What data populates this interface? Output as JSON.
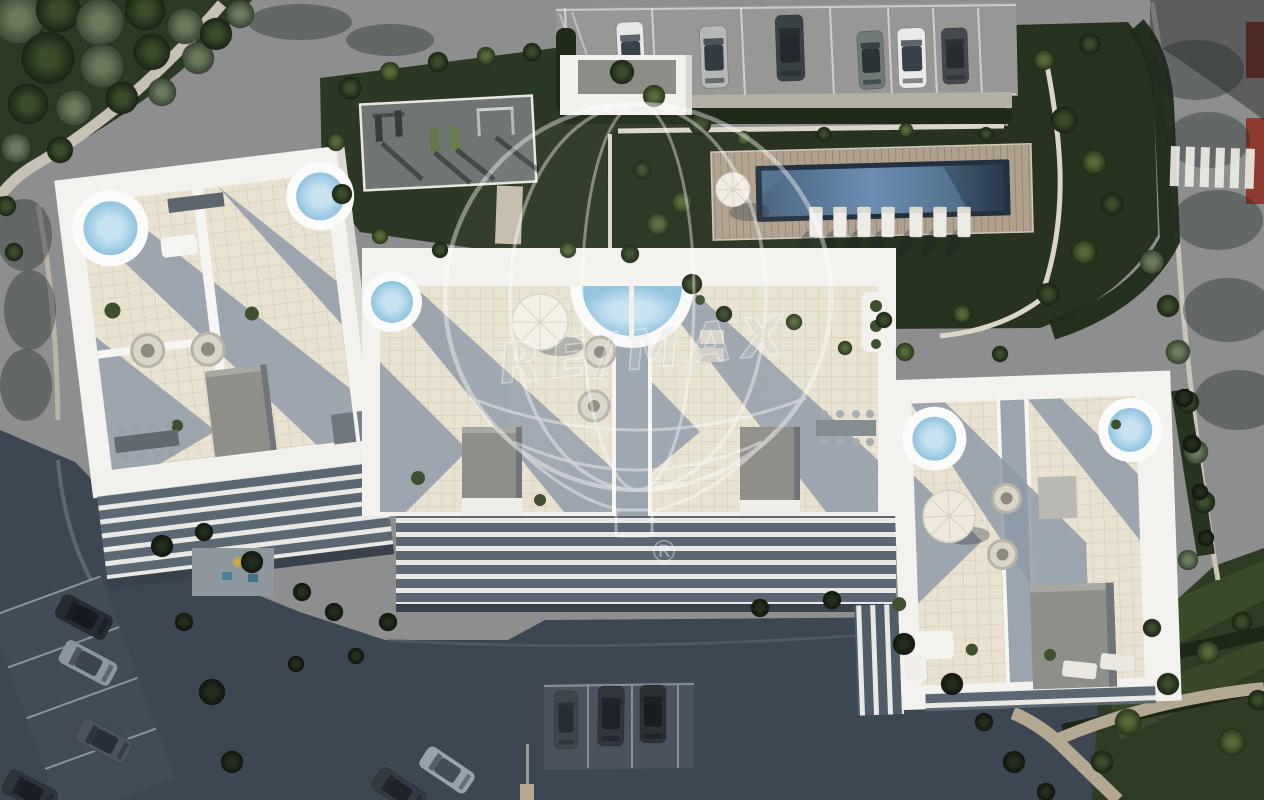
{
  "watermark": {
    "brand": "RE/MAX",
    "registered_symbol": "®"
  },
  "scene": {
    "description": "Aerial render of modern white apartment complex with rooftop jacuzzi terraces, communal pool, outdoor gym, gardens and parking",
    "buildings": [
      "left-residence",
      "center-residence",
      "right-residence"
    ],
    "amenities": [
      "rooftop-jacuzzis",
      "communal-pool",
      "sun-deck",
      "outdoor-gym",
      "gardens",
      "parking"
    ]
  },
  "palette": {
    "road_sunlit": "#8d8e8e",
    "road_shadow": "#3d4753",
    "sidewalk": "#c6c1b4",
    "grass_dark": "#27331e",
    "grass_sun": "#3d4c30",
    "hedge": "#1f2a18",
    "roof_white": "#f3f2ee",
    "terrace_tile": "#e9e2d1",
    "terrace_shadow": "#8d9aa8",
    "roofbox_gray": "#8f8f89",
    "deck_wood": "#b0a18e",
    "pool_deep": "#22313f",
    "pool_light": "#7b9cc3",
    "jacuzzi_water": "#aed3e8",
    "accent_red": "#8d3a30",
    "watermark_white": "rgba(255,255,255,0.75)"
  },
  "parking_top": {
    "stall_lines": [
      565,
      652,
      741,
      830,
      888,
      933,
      978
    ],
    "cars": [
      {
        "x": 631,
        "y": 54,
        "a": -3,
        "w": 27,
        "l": 64,
        "b": "#e8e9e7",
        "g": "#39424a"
      },
      {
        "x": 714,
        "y": 57,
        "a": -2,
        "w": 27,
        "l": 62,
        "b": "#b4b8b7",
        "g": "#323b42"
      },
      {
        "x": 790,
        "y": 48,
        "a": -2,
        "w": 28,
        "l": 66,
        "b": "#3a4144",
        "g": "#23292e"
      },
      {
        "x": 871,
        "y": 60,
        "a": -3,
        "w": 26,
        "l": 58,
        "b": "#6f7a79",
        "g": "#2c3438"
      },
      {
        "x": 912,
        "y": 58,
        "a": -2,
        "w": 28,
        "l": 60,
        "b": "#eaebe9",
        "g": "#39424a"
      },
      {
        "x": 955,
        "y": 56,
        "a": -2,
        "w": 26,
        "l": 56,
        "b": "#44494d",
        "g": "#262c30"
      }
    ]
  },
  "parking_left": {
    "cars": [
      {
        "x": 84,
        "y": 617,
        "a": -62,
        "w": 26,
        "l": 56,
        "b": "#242b31",
        "g": "#141a1f"
      },
      {
        "x": 88,
        "y": 663,
        "a": -62,
        "w": 26,
        "l": 58,
        "b": "#8c969d",
        "g": "#3c454d"
      },
      {
        "x": 104,
        "y": 741,
        "a": -62,
        "w": 26,
        "l": 56,
        "b": "#4b545c",
        "g": "#272e35"
      },
      {
        "x": 30,
        "y": 792,
        "a": -62,
        "w": 26,
        "l": 54,
        "b": "#2e353c",
        "g": "#191f24"
      }
    ]
  },
  "parking_bottom": {
    "cars": [
      {
        "x": 566,
        "y": 720,
        "a": 0,
        "w": 23,
        "l": 58,
        "b": "#3e454c",
        "g": "#262d33"
      },
      {
        "x": 611,
        "y": 716,
        "a": 1,
        "w": 26,
        "l": 60,
        "b": "#30363c",
        "g": "#1c2227"
      },
      {
        "x": 653,
        "y": 714,
        "a": 0,
        "w": 26,
        "l": 58,
        "b": "#2b3136",
        "g": "#181d22"
      },
      {
        "x": 447,
        "y": 770,
        "a": -56,
        "w": 25,
        "l": 56,
        "b": "#99a3aa",
        "g": "#434d55"
      },
      {
        "x": 399,
        "y": 791,
        "a": -56,
        "w": 25,
        "l": 54,
        "b": "#333a41",
        "g": "#1d2329"
      }
    ]
  },
  "pool": {
    "loungers_x": [
      816,
      840,
      864,
      888,
      916,
      940,
      964
    ],
    "lounger_y": 222
  },
  "crosswalk": {
    "x": 1171,
    "y": 146,
    "count": 6,
    "w": 9,
    "h": 40,
    "gap": 6,
    "angle": 2
  },
  "trees": [
    [
      18,
      18,
      26,
      "o"
    ],
    [
      58,
      10,
      22,
      "d"
    ],
    [
      100,
      22,
      24,
      "o"
    ],
    [
      145,
      10,
      20,
      "d"
    ],
    [
      185,
      26,
      18,
      "o"
    ],
    [
      48,
      58,
      26,
      "d"
    ],
    [
      102,
      66,
      22,
      "o"
    ],
    [
      152,
      52,
      18,
      "d"
    ],
    [
      198,
      58,
      16,
      "o"
    ],
    [
      28,
      104,
      20,
      "d"
    ],
    [
      74,
      108,
      18,
      "o"
    ],
    [
      122,
      98,
      16,
      "d"
    ],
    [
      162,
      92,
      14,
      "o"
    ],
    [
      216,
      34,
      16,
      "d"
    ],
    [
      16,
      148,
      15,
      "o"
    ],
    [
      60,
      150,
      13,
      "d"
    ],
    [
      240,
      14,
      14,
      "o"
    ],
    [
      6,
      206,
      10,
      "d"
    ],
    [
      14,
      252,
      9,
      "d"
    ],
    [
      350,
      88,
      11,
      "d"
    ],
    [
      390,
      72,
      10,
      "s"
    ],
    [
      438,
      62,
      10,
      "d"
    ],
    [
      486,
      56,
      9,
      "s"
    ],
    [
      532,
      52,
      9,
      "d"
    ],
    [
      336,
      142,
      9,
      "s"
    ],
    [
      342,
      194,
      10,
      "d"
    ],
    [
      622,
      72,
      12,
      "d"
    ],
    [
      654,
      96,
      11,
      "s"
    ],
    [
      642,
      170,
      9,
      "d"
    ],
    [
      658,
      224,
      11,
      "s"
    ],
    [
      630,
      254,
      9,
      "d"
    ],
    [
      568,
      250,
      8,
      "s"
    ],
    [
      440,
      250,
      8,
      "d"
    ],
    [
      380,
      236,
      8,
      "s"
    ],
    [
      700,
      124,
      11,
      "d"
    ],
    [
      682,
      202,
      10,
      "s"
    ],
    [
      692,
      284,
      10,
      "d"
    ],
    [
      1064,
      120,
      13,
      "d"
    ],
    [
      1094,
      162,
      12,
      "s"
    ],
    [
      1112,
      204,
      11,
      "d"
    ],
    [
      1084,
      252,
      12,
      "s"
    ],
    [
      1048,
      294,
      11,
      "d"
    ],
    [
      962,
      314,
      9,
      "s"
    ],
    [
      884,
      320,
      8,
      "d"
    ],
    [
      794,
      322,
      8,
      "s"
    ],
    [
      724,
      314,
      8,
      "d"
    ],
    [
      744,
      138,
      7,
      "s"
    ],
    [
      824,
      134,
      7,
      "d"
    ],
    [
      906,
      130,
      7,
      "s"
    ],
    [
      986,
      134,
      7,
      "d"
    ],
    [
      1044,
      60,
      10,
      "s"
    ],
    [
      1090,
      44,
      10,
      "d"
    ],
    [
      1152,
      262,
      12,
      "o"
    ],
    [
      1168,
      306,
      11,
      "d"
    ],
    [
      1178,
      352,
      12,
      "o"
    ],
    [
      1188,
      402,
      11,
      "d"
    ],
    [
      1196,
      452,
      12,
      "o"
    ],
    [
      1204,
      502,
      11,
      "d"
    ],
    [
      1188,
      560,
      10,
      "o"
    ],
    [
      905,
      352,
      9,
      "s"
    ],
    [
      1000,
      354,
      8,
      "d"
    ],
    [
      845,
      348,
      7,
      "s"
    ],
    [
      1128,
      722,
      13,
      "s"
    ],
    [
      1168,
      684,
      11,
      "d"
    ],
    [
      1208,
      652,
      11,
      "s"
    ],
    [
      1242,
      622,
      10,
      "d"
    ],
    [
      1102,
      762,
      11,
      "d"
    ],
    [
      1232,
      742,
      13,
      "s"
    ],
    [
      1258,
      700,
      10,
      "d"
    ],
    [
      1152,
      628,
      9,
      "d"
    ],
    [
      162,
      546,
      11,
      "h"
    ],
    [
      204,
      532,
      9,
      "h"
    ],
    [
      252,
      562,
      11,
      "h"
    ],
    [
      302,
      592,
      9,
      "h"
    ],
    [
      334,
      612,
      9,
      "h"
    ],
    [
      212,
      692,
      13,
      "h"
    ],
    [
      232,
      762,
      11,
      "h"
    ],
    [
      184,
      622,
      9,
      "h"
    ],
    [
      388,
      622,
      9,
      "h"
    ],
    [
      760,
      608,
      9,
      "h"
    ],
    [
      832,
      600,
      9,
      "h"
    ],
    [
      904,
      644,
      11,
      "h"
    ],
    [
      952,
      684,
      11,
      "h"
    ],
    [
      984,
      722,
      9,
      "h"
    ],
    [
      1014,
      762,
      11,
      "h"
    ],
    [
      1046,
      792,
      9,
      "h"
    ],
    [
      356,
      656,
      8,
      "h"
    ],
    [
      296,
      664,
      8,
      "h"
    ],
    [
      1184,
      398,
      9,
      "h"
    ],
    [
      1192,
      444,
      9,
      "h"
    ],
    [
      1200,
      492,
      8,
      "h"
    ],
    [
      1206,
      538,
      8,
      "h"
    ]
  ]
}
